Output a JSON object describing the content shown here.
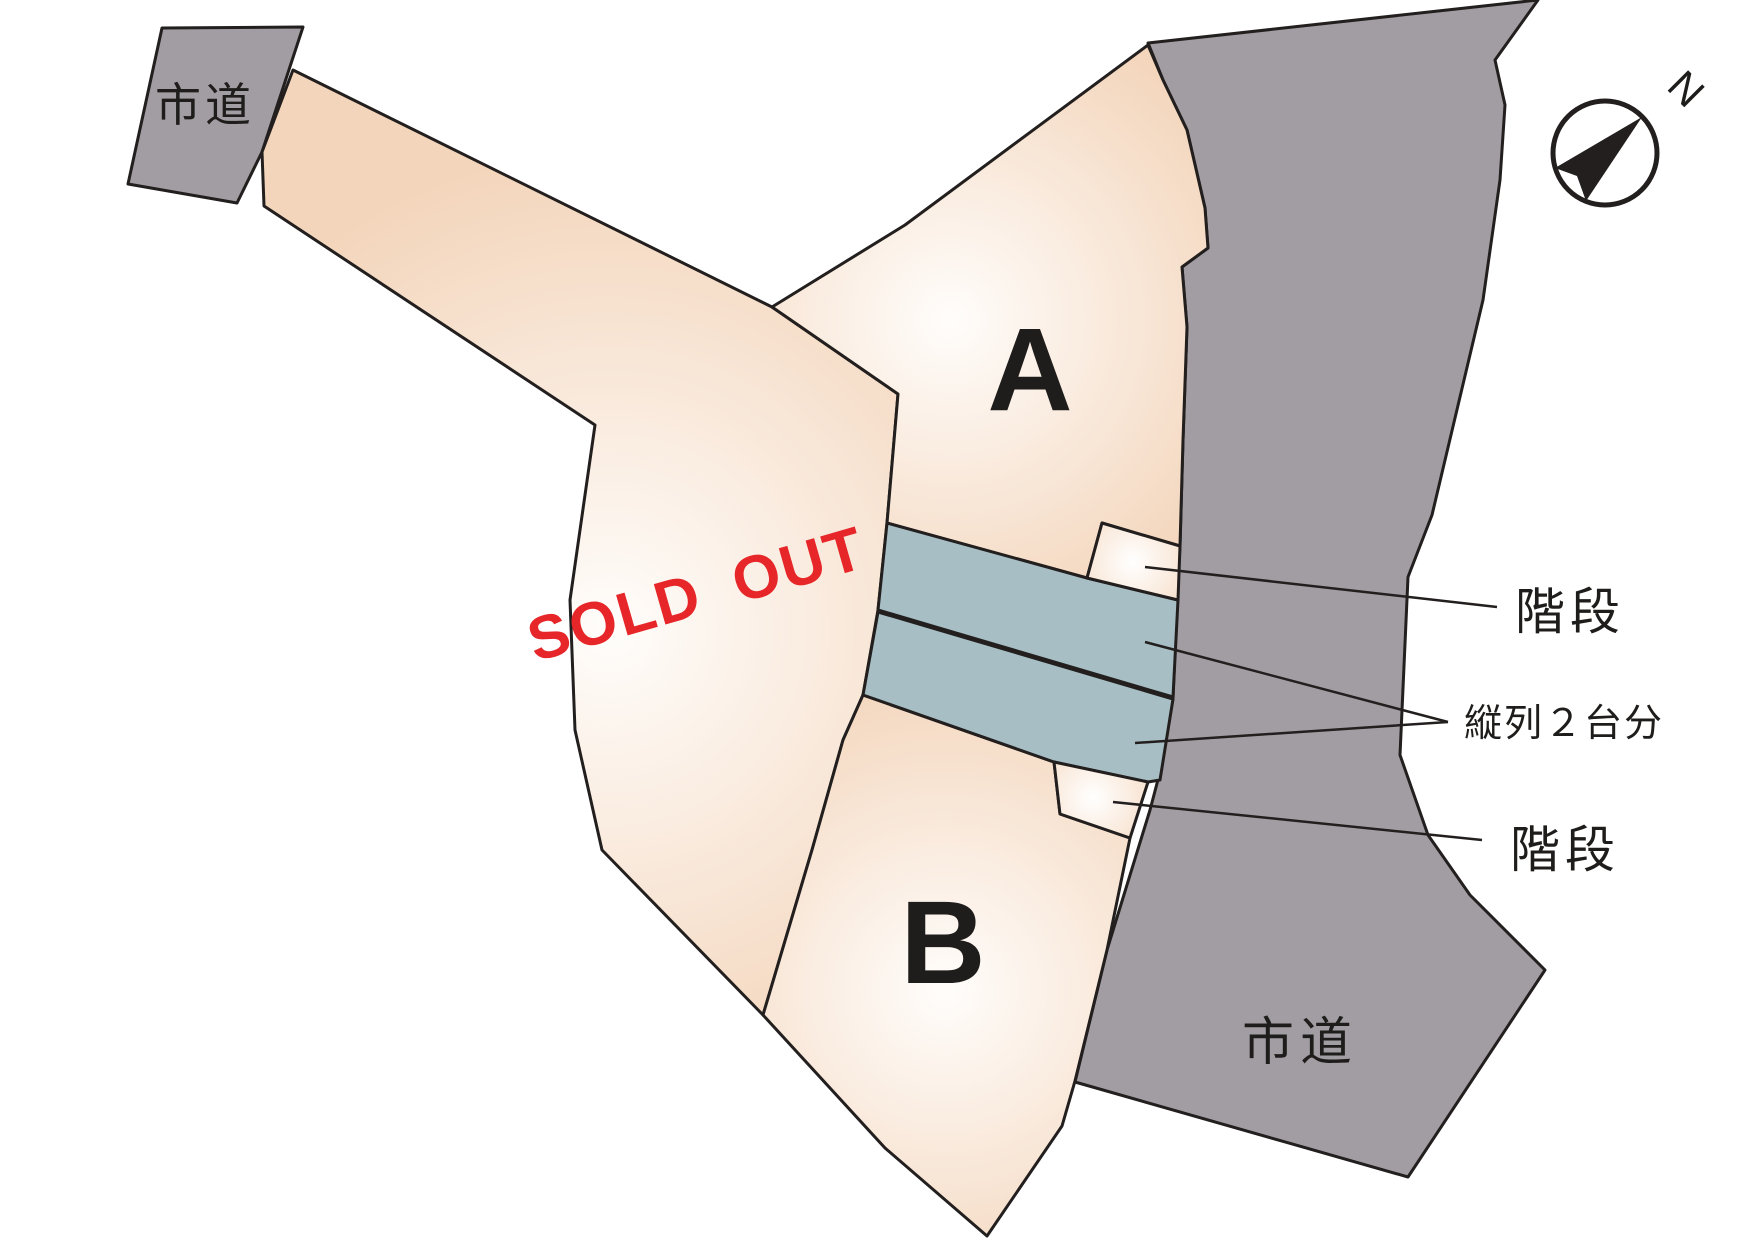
{
  "labels": {
    "road_top_left": "市道",
    "road_right": "市道",
    "lot_a": "A",
    "lot_b": "B",
    "sold_out": "SOLD OUT",
    "stairs_top": "階段",
    "stairs_bottom": "階段",
    "tandem_parking": "縦列２台分",
    "compass_north": "N"
  },
  "colors": {
    "road_gray": "#a29da3",
    "lot_peach": "#f3d5bb",
    "lot_highlight": "#fffdfb",
    "stair_highlight": "#ffffff",
    "stair_edge": "#f6dcc5",
    "parking_blue": "#a7bec4",
    "outline": "#221f1e",
    "sold_out_red": "#e62629",
    "label_dark": "#1f1d1b"
  }
}
